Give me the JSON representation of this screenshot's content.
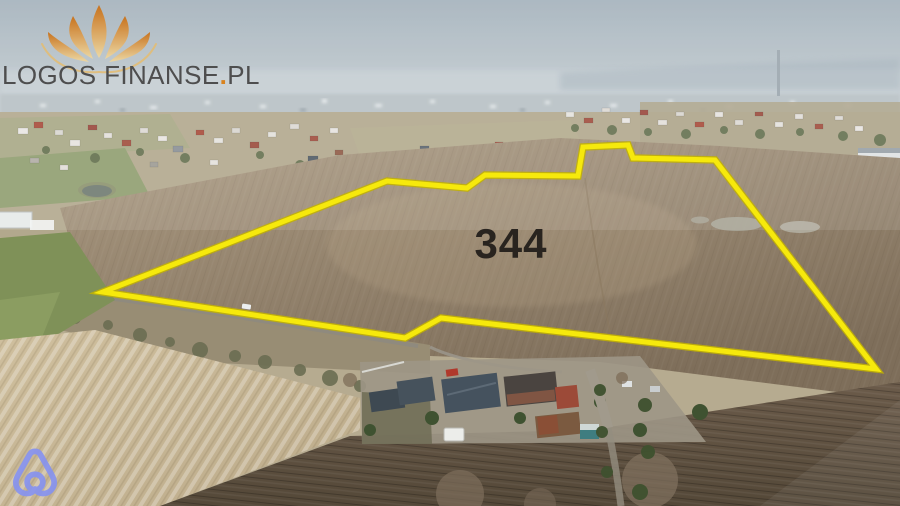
{
  "watermark": {
    "brand": "LOGOS FINANSE",
    "dot": ".",
    "tld": "PL",
    "text_color": "#4e4e4e",
    "dot_color": "#d9831e",
    "lotus_top": "#c96f15",
    "lotus_bottom": "#efd9a2"
  },
  "parcel": {
    "label": "344",
    "outline_color": "#f6e90c",
    "outline_edge_color": "#c3b300",
    "label_color": "#29241f"
  },
  "corner_icon": {
    "name": "belo-house-loop-icon",
    "color": "#8793ef"
  },
  "scene": {
    "sky_top": "#a3b1bb",
    "sky_horizon": "#ccd3d6",
    "field_light": "#ab9a82",
    "field_dark": "#7e6e5a",
    "plowed_dark_top": "#6b5b4a",
    "plowed_dark_bottom": "#544838",
    "tan_field_light": "#cfbf9e",
    "tan_field_dark": "#bcab8a",
    "green_field": "#7f9158",
    "road": "#8f8a7e"
  }
}
